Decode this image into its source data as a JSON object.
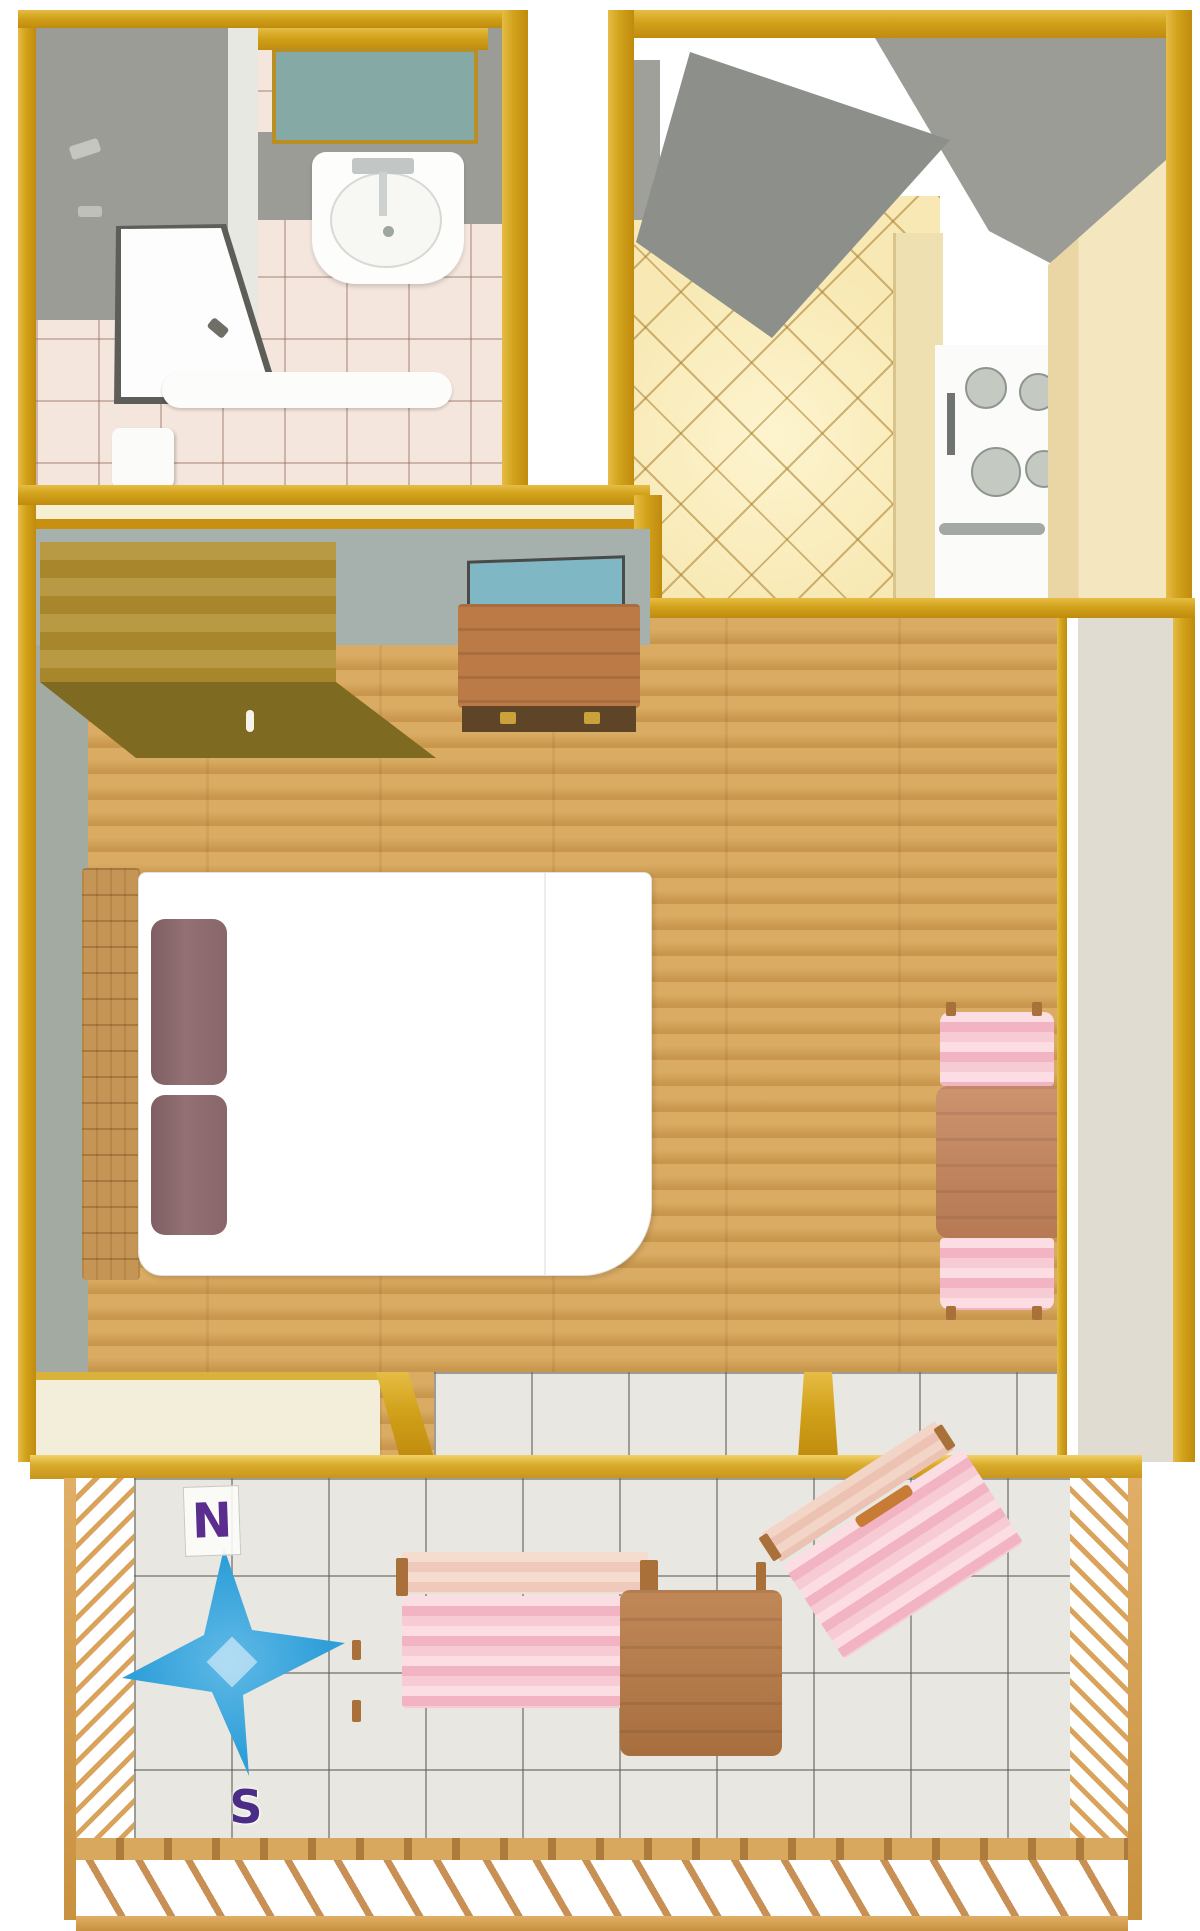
{
  "meta": {
    "type": "floor-plan",
    "description": "Top-down rendered floor plan of a small studio apartment with bathroom, kitchen, main room and balcony"
  },
  "compass": {
    "north_label": "N",
    "south_label": "S",
    "star_color": "#2F9FD9",
    "letter_color": "#5B2D8E"
  },
  "rooms": {
    "bathroom": {
      "fixtures": [
        "teal-window",
        "sink",
        "faucet",
        "shower-enclosure",
        "toilet",
        "bathtub",
        "pink-tile-floor",
        "gray-walls"
      ]
    },
    "kitchen": {
      "fixtures": [
        "open-door",
        "diamond-tile-floor",
        "stove-with-four-burners",
        "oven-handle",
        "counter",
        "tall-cream-cabinet",
        "gray-wall"
      ]
    },
    "main_room": {
      "fixtures": [
        "wardrobe",
        "teal-window",
        "dresser-with-drawers",
        "wood-plank-floor",
        "double-bed",
        "two-mauve-pillows",
        "wood-headboard",
        "dining-table",
        "two-pink-chairs"
      ]
    },
    "balcony": {
      "fixtures": [
        "white-tile-floor",
        "compass-rose",
        "striped-lounger-left",
        "square-table",
        "striped-lounger-right",
        "wood-railing-left",
        "wood-railing-right",
        "wood-railing-bottom"
      ]
    }
  },
  "palette": {
    "wall_gold": "#D1A21A",
    "bathroom_gray": "#9C9C96",
    "bath_window_teal": "#85A9A5",
    "room_window_teal": "#7FB7C4",
    "interior_bluegray": "#A6B1AE",
    "divider_cream": "#F6F0D2",
    "wood_floor": "#D7A557",
    "wardrobe_top": "#B18E2F",
    "wardrobe_front": "#7E6A20",
    "dresser": "#BE7A45",
    "headboard": "#C49554",
    "pillow_mauve": "#8C6A6E",
    "chair_pink": "#F4BCC8",
    "table_terracotta": "#C5845A",
    "kitchen_tile": "#F8E9B4",
    "cabinet_cream": "#F2E3BA",
    "balcony_tile": "#E9E7E1",
    "compass_blue": "#2F9FD9",
    "compass_purple": "#5B2D8E",
    "railing_wood": "#D2A05C"
  }
}
